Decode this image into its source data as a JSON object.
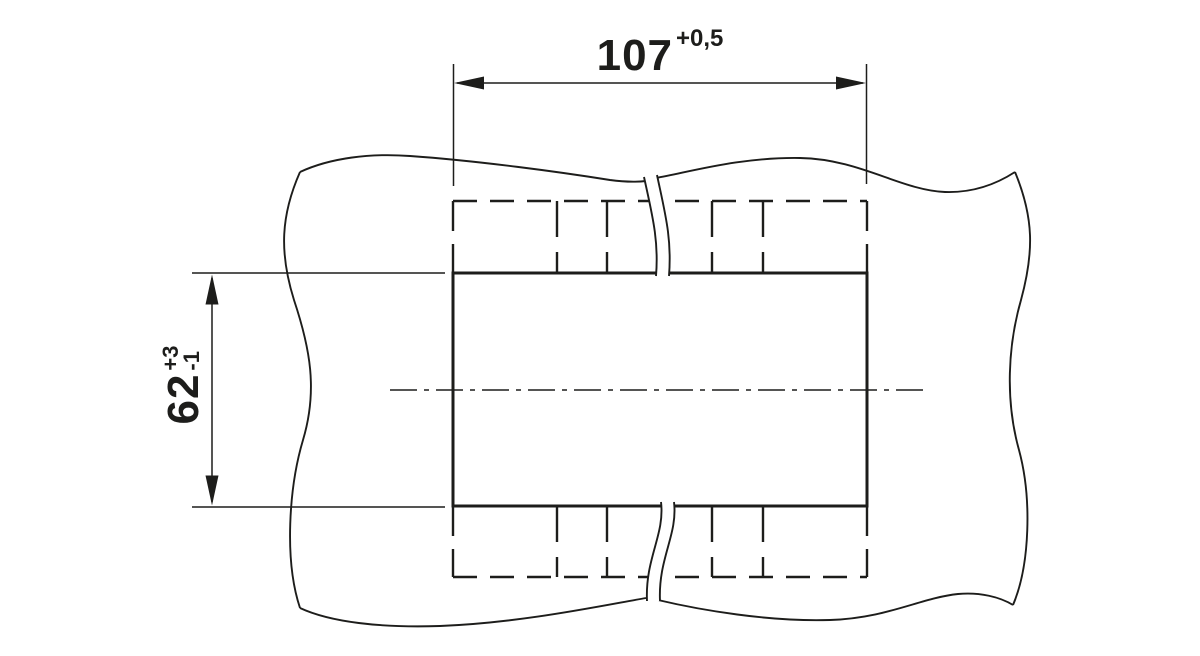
{
  "colors": {
    "background": "#ffffff",
    "line": "#1d1d1b"
  },
  "drawing": {
    "kind": "panel-cutout-dimension-drawing",
    "dimensions": {
      "width": {
        "value": "107",
        "tolerance_upper": "+0,5"
      },
      "height": {
        "value": "62",
        "tolerance_upper": "+3",
        "tolerance_lower": "-1"
      }
    }
  }
}
